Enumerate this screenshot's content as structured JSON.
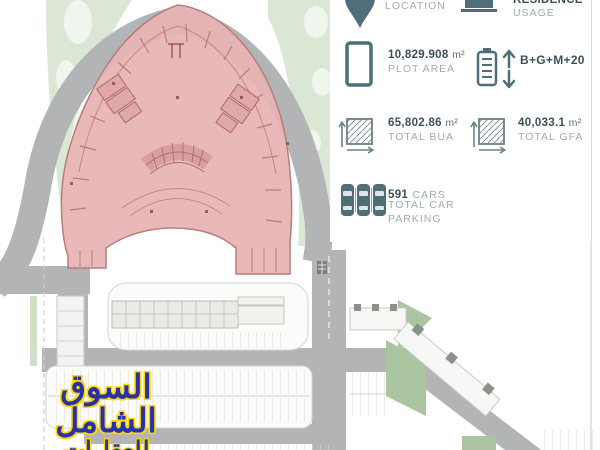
{
  "panel": {
    "location": {
      "label": "LOCATION"
    },
    "usage": {
      "value": "RESIDENCE",
      "label": "USAGE"
    },
    "plot_area": {
      "value": "10,829.908",
      "unit": "m²",
      "label": "PLOT AREA"
    },
    "floors": {
      "value": "B+G+M+20"
    },
    "total_bua": {
      "value": "65,802.86",
      "unit": "m²",
      "label": "TOTAL BUA"
    },
    "total_gfa": {
      "value": "40,033.1",
      "unit": "m²",
      "label": "TOTAL GFA"
    },
    "parking": {
      "count": "591",
      "unit": "CARS",
      "label_line1": "TOTAL CAR",
      "label_line2": "PARKING"
    }
  },
  "watermark": {
    "line1": "السوق الشامل",
    "line2": "للعقارات"
  },
  "colors": {
    "panel_icon": "#4f6e79",
    "value_text": "#3d5059",
    "label_text": "#a2abad",
    "building_fill": "#e7b3b3",
    "building_outline": "#b97c7c",
    "road_gray": "#b2b4b6",
    "landscape_green": "#dbe7d5",
    "patch_green": "#abc5a0",
    "watermark_blue": "#2531ae",
    "watermark_outline": "#ffd700"
  }
}
